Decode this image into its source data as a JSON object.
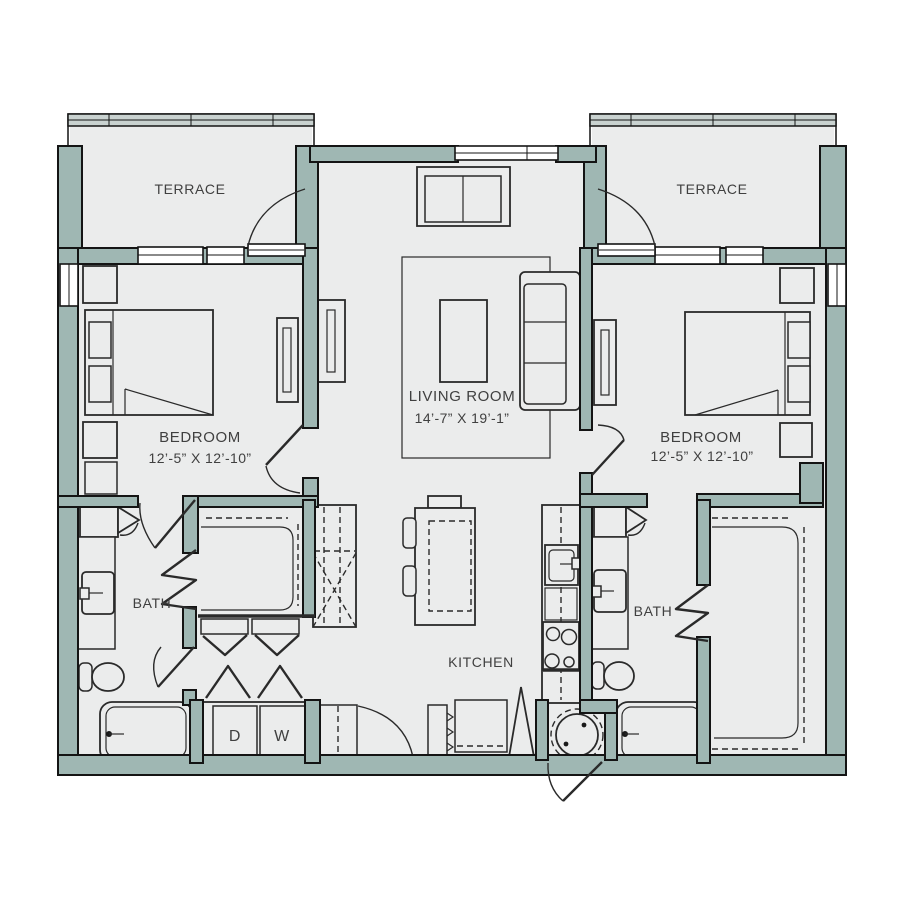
{
  "title": "Two bedroom apartment floor plan",
  "colors": {
    "wall": "#9fb7b3",
    "floor": "#ebecec",
    "railing": "#c9d2d0",
    "line": "#141414",
    "line2": "#2a2a2a",
    "text": "#404040"
  },
  "rooms": {
    "terrace_left": {
      "label": "TERRACE"
    },
    "terrace_right": {
      "label": "TERRACE"
    },
    "bedroom_left": {
      "label": "BEDROOM",
      "dims": "12’-5” X 12’-10”"
    },
    "bedroom_right": {
      "label": "BEDROOM",
      "dims": "12’-5” X 12’-10”"
    },
    "living_room": {
      "label": "LIVING ROOM",
      "dims": "14’-7” X 19’-1”"
    },
    "kitchen": {
      "label": "KITCHEN"
    },
    "bath_left": {
      "label": "BATH"
    },
    "bath_right": {
      "label": "BATH"
    },
    "laundry": {
      "dryer": "D",
      "washer": "W"
    }
  }
}
